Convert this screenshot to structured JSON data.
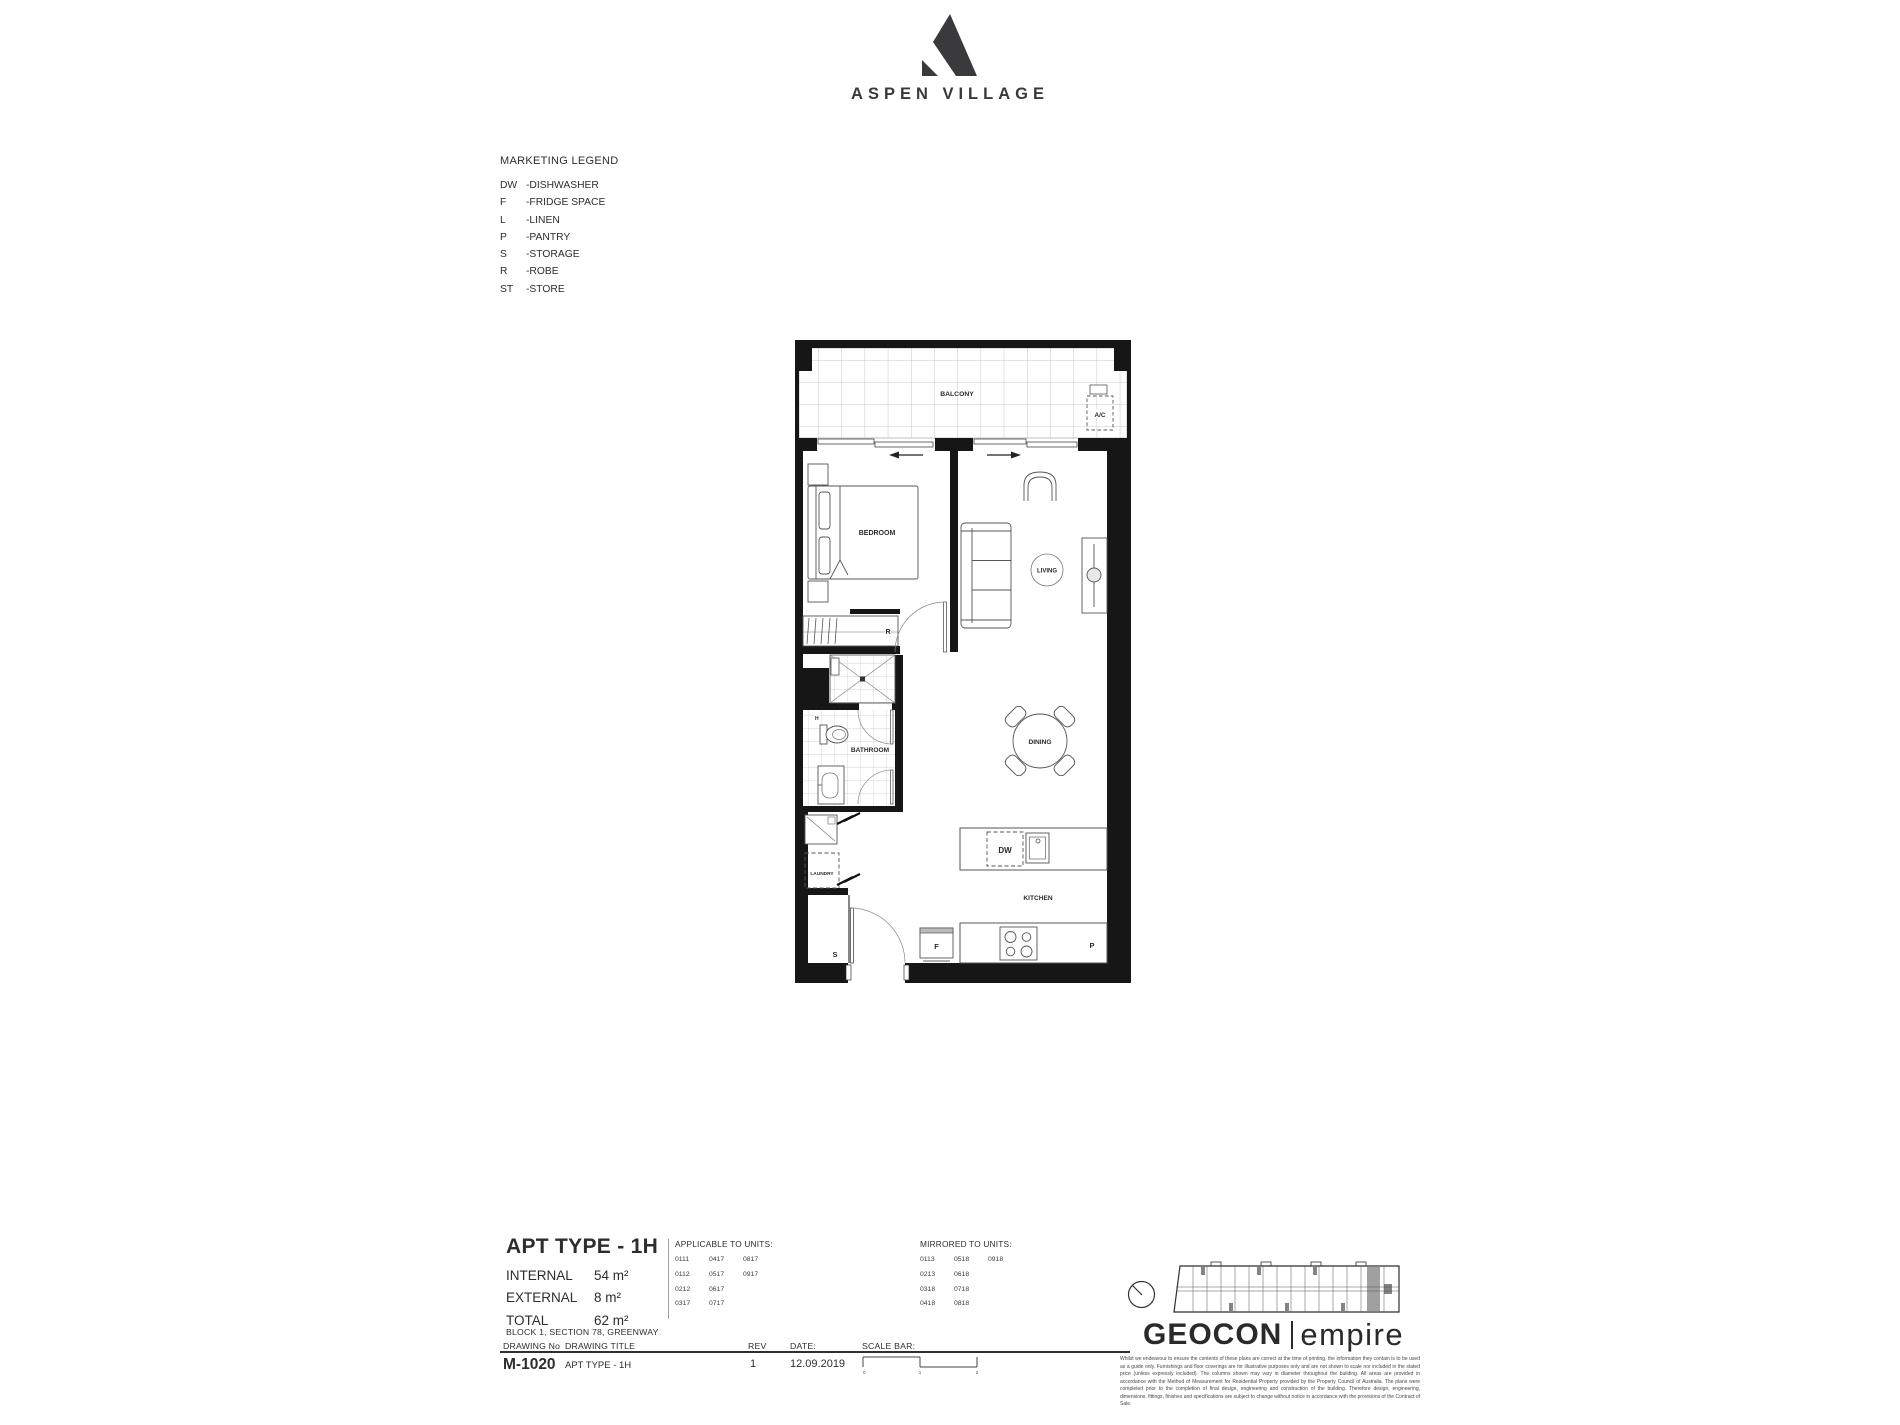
{
  "brand": {
    "name": "ASPEN VILLAGE"
  },
  "legend": {
    "title": "MARKETING LEGEND",
    "items": [
      [
        "DW",
        "-DISHWASHER"
      ],
      [
        "F",
        "-FRIDGE SPACE"
      ],
      [
        "L",
        "-LINEN"
      ],
      [
        "P",
        "-PANTRY"
      ],
      [
        "S",
        "-STORAGE"
      ],
      [
        "R",
        "-ROBE"
      ],
      [
        "ST",
        "-STORE"
      ]
    ]
  },
  "plan": {
    "labels": {
      "balcony": "BALCONY",
      "ac": "A/C",
      "bedroom": "BEDROOM",
      "robe": "R",
      "bathroom": "BATHROOM",
      "h": "H",
      "laundry": "LAUNDRY",
      "storage": "S",
      "living": "LIVING",
      "dining": "DINING",
      "kitchen": "KITCHEN",
      "dishwasher": "DW",
      "fridge": "F",
      "pantry": "P"
    }
  },
  "titleblock": {
    "apt_type": "APT TYPE - 1H",
    "areas": [
      [
        "INTERNAL",
        "54 m²"
      ],
      [
        "EXTERNAL",
        "8 m²"
      ],
      [
        "TOTAL",
        "62 m²"
      ]
    ],
    "location": "BLOCK 1, SECTION 78, GREENWAY",
    "drawing_no_label": "DRAWING No",
    "drawing_title_label": "DRAWING TITLE",
    "rev_label": "REV",
    "date_label": "DATE:",
    "scale_bar_label": "SCALE BAR:",
    "drawing_no": "M-1020",
    "drawing_title": "APT TYPE - 1H",
    "rev": "1",
    "date": "12.09.2019",
    "scale_ticks": [
      "0",
      "1",
      "2"
    ]
  },
  "units": {
    "applicable_title": "APPLICABLE TO UNITS:",
    "applicable_columns": [
      [
        "0111",
        "0112",
        "0212",
        "0317"
      ],
      [
        "0417",
        "0517",
        "0617",
        "0717"
      ],
      [
        "0817",
        "0917"
      ]
    ],
    "mirrored_title": "MIRRORED TO UNITS:",
    "mirrored_columns": [
      [
        "0113",
        "0213",
        "0318",
        "0418"
      ],
      [
        "0518",
        "0618",
        "0718",
        "0818"
      ],
      [
        "0918"
      ]
    ]
  },
  "footer_brand": {
    "geocon": "GEOCON",
    "empire": "empire"
  },
  "disclaimer": "Whilst we endeavour to ensure the contents of these plans are correct at the time of printing, the information they contain is to be used as a guide only. Furnishings and floor coverings are for illustrative purposes only and are not shown to scale nor included in the stated price (unless expressly included). The columns shown may vary in diameter throughout the building. All areas are provided in accordance with the Method of Measurement for Residential Property provided by the Property Council of Australia. The plans were completed prior to the completion of final design, engineering and construction of the building. Therefore design, engineering, dimensions, fittings, finishes and specifications are subject to change without notice in accordance with the provisions of the Contract of Sale.",
  "colors": {
    "ink": "#2d2d2f",
    "wall": "#161616",
    "furniture": "#555555",
    "highlight": "#a0a0a0"
  }
}
